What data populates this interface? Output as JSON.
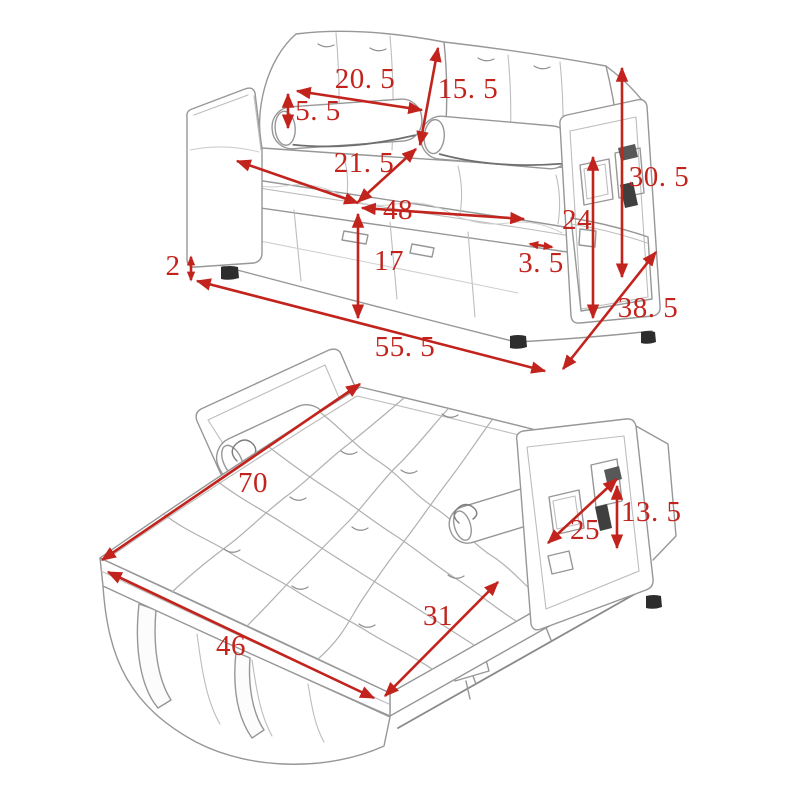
{
  "diagram": {
    "subject": "convertible sleeper sofa with pull-out bed, dimension drawing",
    "accent_color": "#c2231c",
    "sketch_color": "#979797",
    "sofa_view": {
      "back_cushion_width": "20. 5",
      "backrest_height": "15. 5",
      "pillow_height": "5. 5",
      "seat_depth": "21. 5",
      "seat_width": "48",
      "armrest_height": "30. 5",
      "side_pocket_height": "24",
      "seat_front_height": "17",
      "armrest_thickness": "3. 5",
      "leg_height": "2",
      "overall_depth": "38. 5",
      "overall_width": "55. 5"
    },
    "bed_view": {
      "bed_length": "70",
      "side_pocket_width": "25",
      "armrest_panel_height": "13. 5",
      "pullout_extension": "31",
      "bed_width": "46"
    }
  }
}
